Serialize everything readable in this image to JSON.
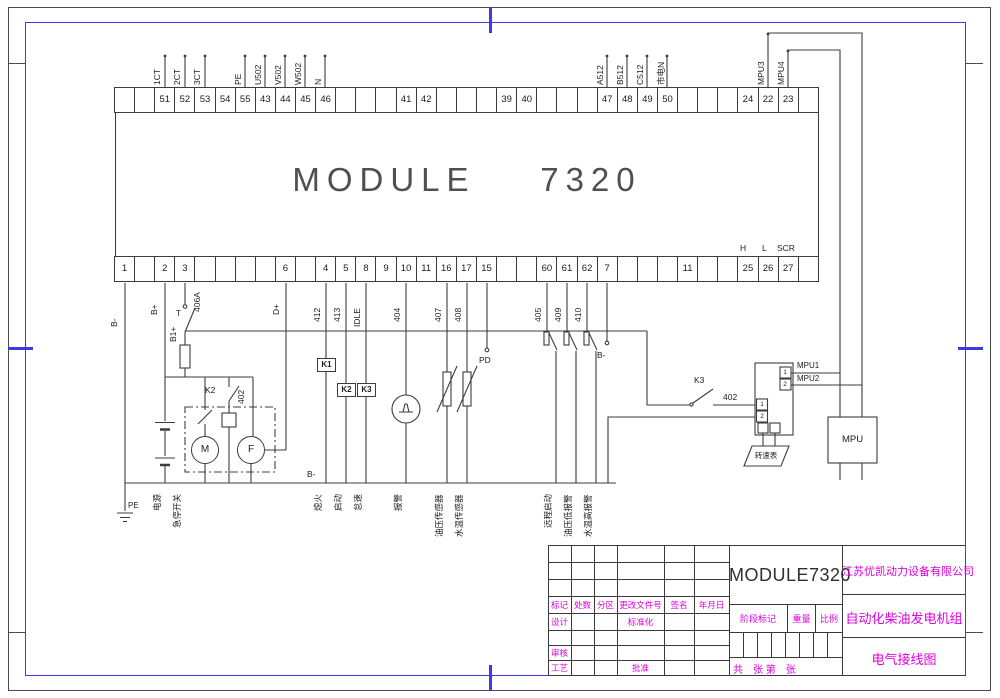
{
  "drawing": {
    "module_title": "MODULE    7320",
    "pin_group": {
      "h": "H",
      "l": "L",
      "scr": "SCR"
    },
    "terminals": {
      "top_cells": [
        "",
        "",
        "51",
        "52",
        "53",
        "54",
        "55",
        "43",
        "44",
        "45",
        "46",
        "",
        "",
        "",
        "41",
        "42",
        "",
        "",
        "",
        "39",
        "40",
        "",
        "",
        "",
        "47",
        "48",
        "49",
        "50",
        "",
        "",
        "",
        "24",
        "22",
        "23",
        ""
      ],
      "top_wire_labels": [
        "",
        "",
        "1CT",
        "2CT",
        "3CT",
        "",
        "PE",
        "U502",
        "V502",
        "W502",
        "N",
        "",
        "",
        "",
        "",
        "",
        "",
        "",
        "",
        "",
        "",
        "",
        "",
        "",
        "A512",
        "B512",
        "C512",
        "市电N",
        "",
        "",
        "",
        "",
        "MPU3",
        "MPU4",
        ""
      ],
      "bottom_cells": [
        "1",
        "",
        "2",
        "3",
        "",
        "",
        "",
        "",
        "6",
        "",
        "4",
        "5",
        "8",
        "9",
        "10",
        "11",
        "16",
        "17",
        "15",
        "",
        "",
        "60",
        "61",
        "62",
        "7",
        "",
        "",
        "",
        "11",
        "",
        "",
        "25",
        "26",
        "27",
        ""
      ]
    },
    "labels": {
      "b_minus": "B-",
      "b_plus": "B+",
      "b1_plus": "B1+",
      "t_switch": "T",
      "w406a": "406A",
      "d_plus": "D+",
      "w412": "412",
      "w413": "413",
      "idle": "IDLE",
      "w404": "404",
      "w407": "407",
      "w408": "408",
      "w405": "405",
      "w409": "409",
      "w410": "410",
      "k1_box": "K1",
      "k2_box": "K2",
      "k3_box": "K3",
      "k2_contact": "K2",
      "w402_left": "402",
      "k3_contact": "K3",
      "w402_right": "402",
      "pd": "PD",
      "b_minus_bus": "B-",
      "b_minus_7": "B-",
      "motor": "M",
      "generator": "F",
      "conv_l1": "1",
      "conv_l2": "2",
      "conv_r1": "1",
      "conv_r2": "2",
      "mpu1": "MPU1",
      "mpu2": "MPU2",
      "mpu": "MPU",
      "tachometer": "转速表",
      "pe": "PE"
    },
    "engine_labels": [
      "电源",
      "急停开关",
      "熄火",
      "启动",
      "怠速",
      "报警",
      "油压传感器",
      "水温传感器",
      "远程启动",
      "油压低报警",
      "水温高报警"
    ]
  },
  "title_block": {
    "model": "MODULE7320",
    "company": "江苏优凯动力设备有限公司",
    "product": "自动化柴油发电机组",
    "drawing_name": "电气接线图",
    "header_cells": [
      "标记",
      "处数",
      "分区",
      "更改文件号",
      "签名",
      "年月日"
    ],
    "design": "设计",
    "standardize": "标准化",
    "review": "审核",
    "process": "工艺",
    "approve": "批准",
    "stage": "阶段标记",
    "weight": "重量",
    "scale": "比例",
    "sheets": "共　张 第　张"
  },
  "colors": {
    "line": "#3c3c3c",
    "accent_blue": "#3c3cdf",
    "magenta": "#dd00dd"
  }
}
